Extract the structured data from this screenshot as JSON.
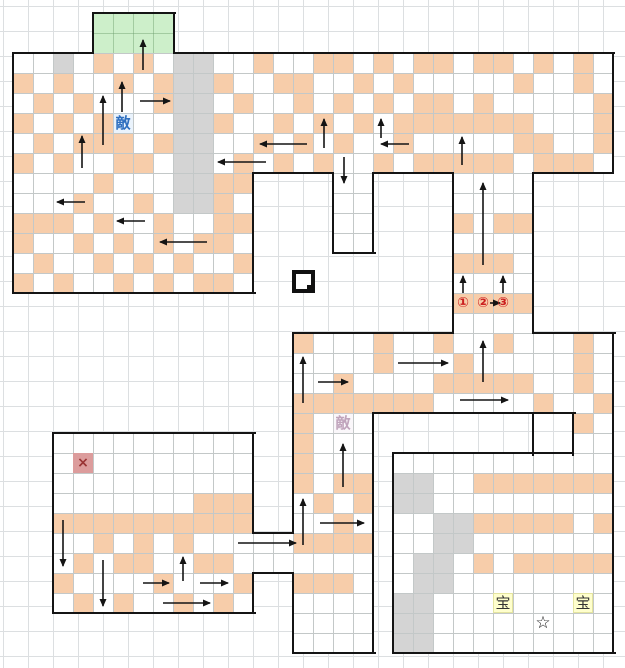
{
  "map": {
    "cell": 20,
    "origin": [
      13,
      13
    ],
    "colors": {
      "floor_line": "#c3c8c8",
      "page_grid": "#dcdfe1",
      "wall": "#141414",
      "peach": "#f7cdaa",
      "gray": "#d4d4d4",
      "green": "#cdefca",
      "enemy_blue": "#2e6fc0",
      "enemy_faded": "#c0a4bc",
      "treasure_bg": "#ffffcd",
      "cross_bg": "#dc9c9c",
      "route_red": "#cc2020"
    },
    "regions": [
      {
        "x": 93,
        "y": 13,
        "w": 81,
        "h": 40,
        "kind": "green",
        "name": "exit-room"
      },
      {
        "x": 13,
        "y": 53,
        "w": 600,
        "h": 120,
        "kind": "floor",
        "name": "top-band"
      },
      {
        "x": 13,
        "y": 173,
        "w": 240,
        "h": 120,
        "kind": "floor",
        "name": "top-left-room-lower"
      },
      {
        "x": 333,
        "y": 173,
        "w": 40,
        "h": 80,
        "kind": "floor",
        "name": "center-stub"
      },
      {
        "x": 453,
        "y": 173,
        "w": 80,
        "h": 160,
        "kind": "floor",
        "name": "right-corridor"
      },
      {
        "x": 293,
        "y": 333,
        "w": 320,
        "h": 80,
        "kind": "floor",
        "name": "middle-band"
      },
      {
        "x": 573,
        "y": 413,
        "w": 40,
        "h": 40,
        "kind": "floor",
        "name": "right-connector"
      },
      {
        "x": 393,
        "y": 453,
        "w": 220,
        "h": 200,
        "kind": "floor",
        "name": "bottom-right-room"
      },
      {
        "x": 293,
        "y": 413,
        "w": 80,
        "h": 240,
        "kind": "floor",
        "name": "bottom-corridor"
      },
      {
        "x": 253,
        "y": 533,
        "w": 40,
        "h": 40,
        "kind": "floor",
        "name": "left-connector"
      },
      {
        "x": 53,
        "y": 433,
        "w": 200,
        "h": 180,
        "kind": "floor",
        "name": "bottom-left-room"
      }
    ],
    "walls_h": [
      [
        13,
        53,
        80
      ],
      [
        174,
        53,
        440
      ],
      [
        93,
        13,
        82
      ],
      [
        373,
        173,
        80
      ],
      [
        253,
        173,
        80
      ],
      [
        333,
        253,
        42
      ],
      [
        533,
        173,
        80
      ],
      [
        13,
        293,
        242
      ],
      [
        293,
        333,
        160
      ],
      [
        533,
        333,
        82
      ],
      [
        373,
        413,
        202
      ],
      [
        393,
        453,
        180
      ],
      [
        253,
        533,
        40
      ],
      [
        253,
        573,
        40
      ],
      [
        53,
        433,
        202
      ],
      [
        53,
        613,
        202
      ],
      [
        293,
        653,
        82
      ],
      [
        393,
        653,
        222
      ]
    ],
    "walls_v": [
      [
        13,
        53,
        240
      ],
      [
        93,
        13,
        40
      ],
      [
        174,
        13,
        40
      ],
      [
        613,
        53,
        120
      ],
      [
        533,
        173,
        160
      ],
      [
        453,
        173,
        160
      ],
      [
        333,
        173,
        80
      ],
      [
        373,
        173,
        80
      ],
      [
        253,
        173,
        120
      ],
      [
        293,
        333,
        200
      ],
      [
        293,
        573,
        80
      ],
      [
        613,
        333,
        320
      ],
      [
        373,
        413,
        240
      ],
      [
        533,
        413,
        42
      ],
      [
        573,
        413,
        42
      ],
      [
        393,
        453,
        200
      ],
      [
        253,
        433,
        100
      ],
      [
        253,
        573,
        40
      ],
      [
        53,
        433,
        180
      ]
    ],
    "cells": {
      "peach": [
        [
          4,
          2
        ],
        [
          6,
          2
        ],
        [
          12,
          2
        ],
        [
          15,
          2
        ],
        [
          16,
          2
        ],
        [
          18,
          2
        ],
        [
          20,
          2
        ],
        [
          21,
          2
        ],
        [
          23,
          2
        ],
        [
          24,
          2
        ],
        [
          26,
          2
        ],
        [
          28,
          2
        ],
        [
          0,
          3
        ],
        [
          2,
          3
        ],
        [
          5,
          3
        ],
        [
          7,
          3
        ],
        [
          10,
          3
        ],
        [
          13,
          3
        ],
        [
          14,
          3
        ],
        [
          17,
          3
        ],
        [
          19,
          3
        ],
        [
          25,
          3
        ],
        [
          28,
          3
        ],
        [
          1,
          4
        ],
        [
          3,
          4
        ],
        [
          7,
          4
        ],
        [
          11,
          4
        ],
        [
          14,
          4
        ],
        [
          16,
          4
        ],
        [
          18,
          4
        ],
        [
          20,
          4
        ],
        [
          21,
          4
        ],
        [
          23,
          4
        ],
        [
          29,
          4
        ],
        [
          0,
          5
        ],
        [
          2,
          5
        ],
        [
          4,
          5
        ],
        [
          10,
          5
        ],
        [
          13,
          5
        ],
        [
          15,
          5
        ],
        [
          17,
          5
        ],
        [
          19,
          5
        ],
        [
          20,
          5
        ],
        [
          21,
          5
        ],
        [
          22,
          5
        ],
        [
          23,
          5
        ],
        [
          24,
          5
        ],
        [
          25,
          5
        ],
        [
          29,
          5
        ],
        [
          1,
          6
        ],
        [
          3,
          6
        ],
        [
          4,
          6
        ],
        [
          5,
          6
        ],
        [
          7,
          6
        ],
        [
          12,
          6
        ],
        [
          14,
          6
        ],
        [
          16,
          6
        ],
        [
          19,
          6
        ],
        [
          25,
          6
        ],
        [
          26,
          6
        ],
        [
          29,
          6
        ],
        [
          0,
          7
        ],
        [
          2,
          7
        ],
        [
          5,
          7
        ],
        [
          6,
          7
        ],
        [
          11,
          7
        ],
        [
          13,
          7
        ],
        [
          15,
          7
        ],
        [
          18,
          7
        ],
        [
          20,
          7
        ],
        [
          21,
          7
        ],
        [
          22,
          7
        ],
        [
          23,
          7
        ],
        [
          24,
          7
        ],
        [
          26,
          7
        ],
        [
          27,
          7
        ],
        [
          28,
          7
        ],
        [
          4,
          8
        ],
        [
          10,
          8
        ],
        [
          11,
          8
        ],
        [
          3,
          9
        ],
        [
          6,
          9
        ],
        [
          10,
          9
        ],
        [
          0,
          10
        ],
        [
          1,
          10
        ],
        [
          2,
          10
        ],
        [
          4,
          10
        ],
        [
          7,
          10
        ],
        [
          10,
          10
        ],
        [
          11,
          10
        ],
        [
          22,
          10
        ],
        [
          24,
          10
        ],
        [
          25,
          10
        ],
        [
          0,
          11
        ],
        [
          3,
          11
        ],
        [
          5,
          11
        ],
        [
          7,
          11
        ],
        [
          9,
          11
        ],
        [
          10,
          11
        ],
        [
          1,
          12
        ],
        [
          4,
          12
        ],
        [
          6,
          12
        ],
        [
          8,
          12
        ],
        [
          11,
          12
        ],
        [
          22,
          12
        ],
        [
          23,
          12
        ],
        [
          24,
          12
        ],
        [
          0,
          13
        ],
        [
          2,
          13
        ],
        [
          5,
          13
        ],
        [
          7,
          13
        ],
        [
          9,
          13
        ],
        [
          10,
          13
        ],
        [
          22,
          14
        ],
        [
          23,
          14
        ],
        [
          24,
          14
        ],
        [
          25,
          14
        ],
        [
          14,
          16
        ],
        [
          18,
          16
        ],
        [
          21,
          16
        ],
        [
          24,
          16
        ],
        [
          28,
          16
        ],
        [
          18,
          17
        ],
        [
          22,
          17
        ],
        [
          28,
          17
        ],
        [
          16,
          18
        ],
        [
          21,
          18
        ],
        [
          22,
          18
        ],
        [
          23,
          18
        ],
        [
          24,
          18
        ],
        [
          25,
          18
        ],
        [
          28,
          18
        ],
        [
          14,
          19
        ],
        [
          15,
          19
        ],
        [
          16,
          19
        ],
        [
          17,
          19
        ],
        [
          18,
          19
        ],
        [
          19,
          19
        ],
        [
          20,
          19
        ],
        [
          26,
          19
        ],
        [
          29,
          19
        ],
        [
          14,
          20
        ],
        [
          28,
          20
        ],
        [
          14,
          21
        ],
        [
          14,
          22
        ],
        [
          14,
          23
        ],
        [
          16,
          23
        ],
        [
          17,
          23
        ],
        [
          23,
          23
        ],
        [
          24,
          23
        ],
        [
          25,
          23
        ],
        [
          26,
          23
        ],
        [
          27,
          23
        ],
        [
          28,
          23
        ],
        [
          29,
          23
        ],
        [
          15,
          24
        ],
        [
          17,
          24
        ],
        [
          9,
          24
        ],
        [
          10,
          24
        ],
        [
          11,
          24
        ],
        [
          16,
          25
        ],
        [
          2,
          25
        ],
        [
          3,
          25
        ],
        [
          4,
          25
        ],
        [
          5,
          25
        ],
        [
          6,
          25
        ],
        [
          7,
          25
        ],
        [
          8,
          25
        ],
        [
          9,
          25
        ],
        [
          10,
          25
        ],
        [
          11,
          25
        ],
        [
          23,
          25
        ],
        [
          24,
          25
        ],
        [
          25,
          25
        ],
        [
          26,
          25
        ],
        [
          27,
          25
        ],
        [
          29,
          25
        ],
        [
          14,
          26
        ],
        [
          15,
          26
        ],
        [
          16,
          26
        ],
        [
          17,
          26
        ],
        [
          4,
          26
        ],
        [
          6,
          26
        ],
        [
          8,
          26
        ],
        [
          3,
          27
        ],
        [
          5,
          27
        ],
        [
          6,
          27
        ],
        [
          9,
          27
        ],
        [
          10,
          27
        ],
        [
          23,
          27
        ],
        [
          25,
          27
        ],
        [
          26,
          27
        ],
        [
          27,
          27
        ],
        [
          28,
          27
        ],
        [
          29,
          27
        ],
        [
          14,
          28
        ],
        [
          15,
          28
        ],
        [
          16,
          28
        ],
        [
          2,
          28
        ],
        [
          7,
          28
        ],
        [
          11,
          28
        ],
        [
          3,
          29
        ],
        [
          5,
          29
        ],
        [
          8,
          29
        ],
        [
          10,
          29
        ]
      ],
      "gray": [
        [
          2,
          2
        ],
        [
          8,
          2
        ],
        [
          9,
          2
        ],
        [
          8,
          3
        ],
        [
          9,
          3
        ],
        [
          8,
          4
        ],
        [
          9,
          4
        ],
        [
          8,
          5
        ],
        [
          9,
          5
        ],
        [
          8,
          6
        ],
        [
          9,
          6
        ],
        [
          8,
          7
        ],
        [
          9,
          7
        ],
        [
          8,
          8
        ],
        [
          9,
          8
        ],
        [
          8,
          9
        ],
        [
          9,
          9
        ],
        [
          19,
          23
        ],
        [
          20,
          23
        ],
        [
          19,
          24
        ],
        [
          20,
          24
        ],
        [
          21,
          25
        ],
        [
          22,
          25
        ],
        [
          21,
          26
        ],
        [
          22,
          26
        ],
        [
          20,
          27
        ],
        [
          21,
          27
        ],
        [
          20,
          28
        ],
        [
          21,
          28
        ],
        [
          19,
          29
        ],
        [
          20,
          29
        ],
        [
          19,
          30
        ],
        [
          20,
          30
        ],
        [
          19,
          31
        ],
        [
          20,
          31
        ]
      ]
    },
    "markers": [
      {
        "type": "enemy",
        "name": "enemy-label-1",
        "text": "敵",
        "c": 5,
        "r": 5
      },
      {
        "type": "enemy-faded",
        "name": "enemy-label-2",
        "text": "敵",
        "c": 16,
        "r": 20
      },
      {
        "type": "routenum",
        "name": "route-number-1",
        "text": "①",
        "c": 22,
        "r": 14
      },
      {
        "type": "routenum",
        "name": "route-number-2",
        "text": "②",
        "c": 23,
        "r": 14
      },
      {
        "type": "routenum",
        "name": "route-number-3",
        "text": "③",
        "c": 24,
        "r": 14
      },
      {
        "type": "cross",
        "name": "cross-marker",
        "text": "×",
        "c": 3,
        "r": 22
      },
      {
        "type": "treasure",
        "name": "treasure-label-1",
        "text": "宝",
        "c": 24,
        "r": 29
      },
      {
        "type": "treasure",
        "name": "treasure-label-2",
        "text": "宝",
        "c": 28,
        "r": 29
      },
      {
        "type": "star",
        "name": "star-marker",
        "text": "☆",
        "c": 26,
        "r": 30
      }
    ],
    "position_icon": {
      "x": 292,
      "y": 270,
      "size": 15,
      "dot": 8,
      "dot_x": 307,
      "dot_y": 285
    },
    "arrows": [
      [
        143,
        70,
        143,
        40
      ],
      [
        122,
        112,
        122,
        82
      ],
      [
        140,
        101,
        170,
        101
      ],
      [
        103,
        145,
        103,
        96
      ],
      [
        82,
        168,
        82,
        136
      ],
      [
        85,
        202,
        57,
        202
      ],
      [
        145,
        221,
        117,
        221
      ],
      [
        207,
        242,
        160,
        242
      ],
      [
        307,
        144,
        260,
        144
      ],
      [
        324,
        148,
        324,
        119
      ],
      [
        266,
        162,
        218,
        162
      ],
      [
        344,
        157,
        344,
        183
      ],
      [
        409,
        144,
        381,
        144
      ],
      [
        381,
        138,
        381,
        119
      ],
      [
        462,
        165,
        462,
        137
      ],
      [
        483,
        265,
        483,
        183
      ],
      [
        463,
        293,
        463,
        276
      ],
      [
        503,
        293,
        503,
        276
      ],
      [
        490,
        303,
        500,
        303
      ],
      [
        303,
        403,
        303,
        357
      ],
      [
        318,
        382,
        348,
        382
      ],
      [
        398,
        363,
        448,
        363
      ],
      [
        483,
        382,
        483,
        341
      ],
      [
        460,
        400,
        508,
        400
      ],
      [
        343,
        487,
        343,
        444
      ],
      [
        303,
        545,
        303,
        499
      ],
      [
        320,
        523,
        364,
        523
      ],
      [
        238,
        543,
        296,
        543
      ],
      [
        63,
        520,
        63,
        566
      ],
      [
        103,
        560,
        103,
        606
      ],
      [
        183,
        581,
        183,
        557
      ],
      [
        143,
        583,
        169,
        583
      ],
      [
        200,
        583,
        228,
        583
      ],
      [
        163,
        603,
        210,
        603
      ]
    ]
  }
}
